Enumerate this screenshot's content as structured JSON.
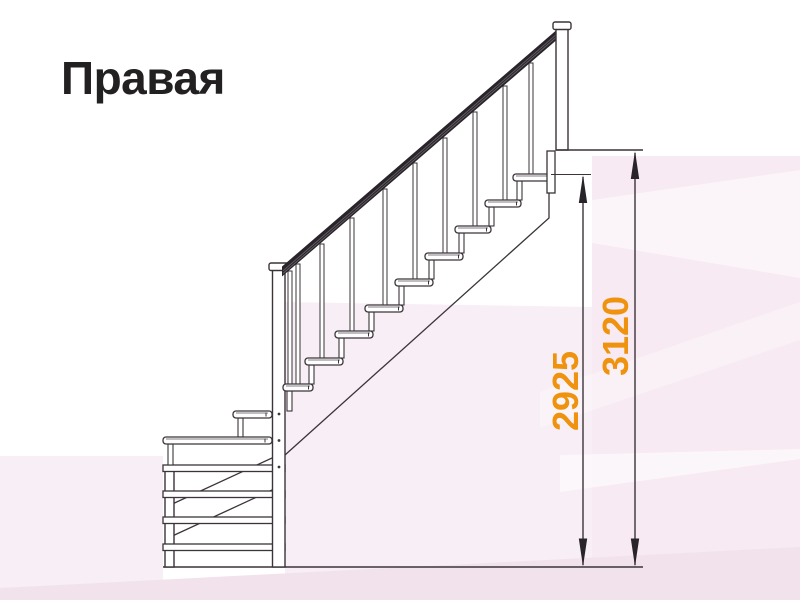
{
  "figure": {
    "title": "Правая",
    "kind": "staircase-side-elevation-drawing"
  },
  "dimensions": {
    "to_top_step": {
      "value": "2925"
    },
    "floor_to_floor": {
      "value": "3120"
    }
  },
  "icons": {
    "arrow_up": "dimension-arrow-up-icon",
    "arrow_down": "dimension-arrow-down-icon"
  },
  "colors": {
    "line": "#3b3439",
    "handrail": "#29242a",
    "dimension_accent": "#ef930f",
    "title": "#232021",
    "canvas": "#ffffff",
    "watermark_pink_right": "#f7eaf2",
    "watermark_pink_mid": "#f8eef5",
    "watermark_pink_strip": "#f2e2ec"
  }
}
